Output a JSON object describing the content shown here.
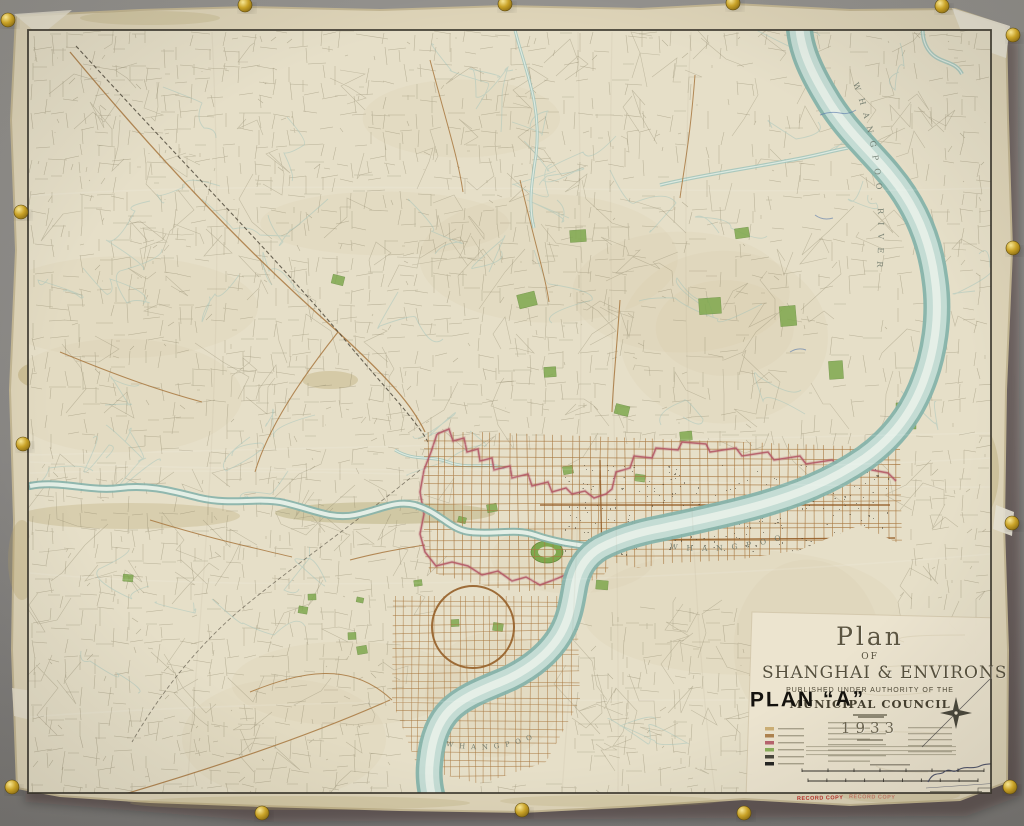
{
  "scene": {
    "description": "Photograph of an aged paper wall map pinned with brass tacks"
  },
  "cartouche": {
    "title_line1": "Plan",
    "title_line2": "OF",
    "title_line3": "SHANGHAI & ENVIRONS",
    "published_line": "PUBLISHED UNDER AUTHORITY OF THE",
    "authority_line": "MUNICIPAL COUNCIL",
    "year": "1933"
  },
  "stamps": {
    "plan_label": "PLAN “A”",
    "record_copy": "RECORD COPY"
  },
  "map_labels": {
    "river_right": "WHANGPOO RIVER",
    "river_upper": "WHANGPOO",
    "river_lower": "WHANGPOO"
  },
  "colors": {
    "wall_top": "#95938f",
    "wall_bottom": "#7b7977",
    "paper": "#ded4b8",
    "paper_edge": "#c4b794",
    "map_bg": "#e6dfc8",
    "border_ink": "#37342a",
    "cadastral": "#8b8468",
    "road": "#a87840",
    "road_dark": "#955f28",
    "boundary_red": "#b25563",
    "river_edge": "#86b3ab",
    "river_fill": "#c4dcd4",
    "river_core": "#e9f1e9",
    "creek": "#9cc2ba",
    "park": "#7fa84e",
    "park_dark": "#5f8838",
    "panel": "#ece4cf",
    "stamp_red": "#b5332c",
    "ink_title": "#56503d",
    "brass": "#c9a227",
    "speck": "#423b2e",
    "stain": "#b5a36a",
    "pencil": "#6a675f",
    "blue_ink": "#5577aa",
    "signature_ink": "#39405c",
    "label_ink": "#5f6b5f"
  }
}
